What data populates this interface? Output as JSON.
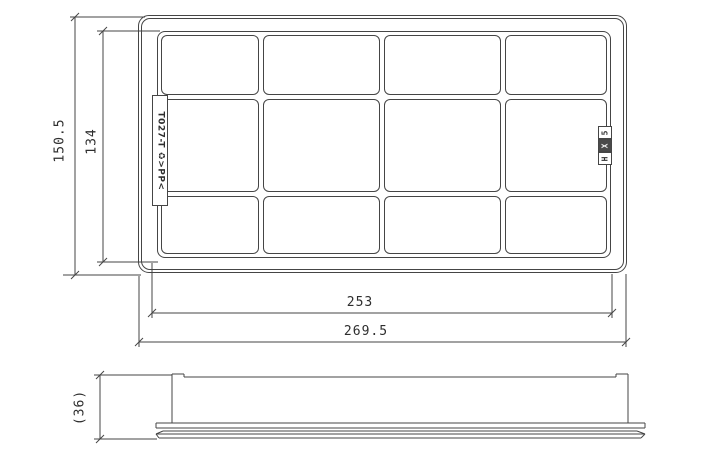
{
  "title": "Air filter element dimensional drawing",
  "colors": {
    "line": "#454545",
    "background": "#ffffff",
    "text": "#2e2e2e",
    "stamp_box_fill": "#4a4a4a",
    "stamp_text_light": "#f4f4f4"
  },
  "top_view": {
    "grid_columns": 4,
    "grid_rows": 3,
    "left_marking": "T027-T ♻>PP<",
    "right_stamp_chars": [
      "5",
      "X",
      "H"
    ]
  },
  "dimensions": {
    "overall_height": "150.5",
    "element_height": "134",
    "element_width": "253",
    "overall_width": "269.5",
    "overall_depth": "(36)"
  }
}
